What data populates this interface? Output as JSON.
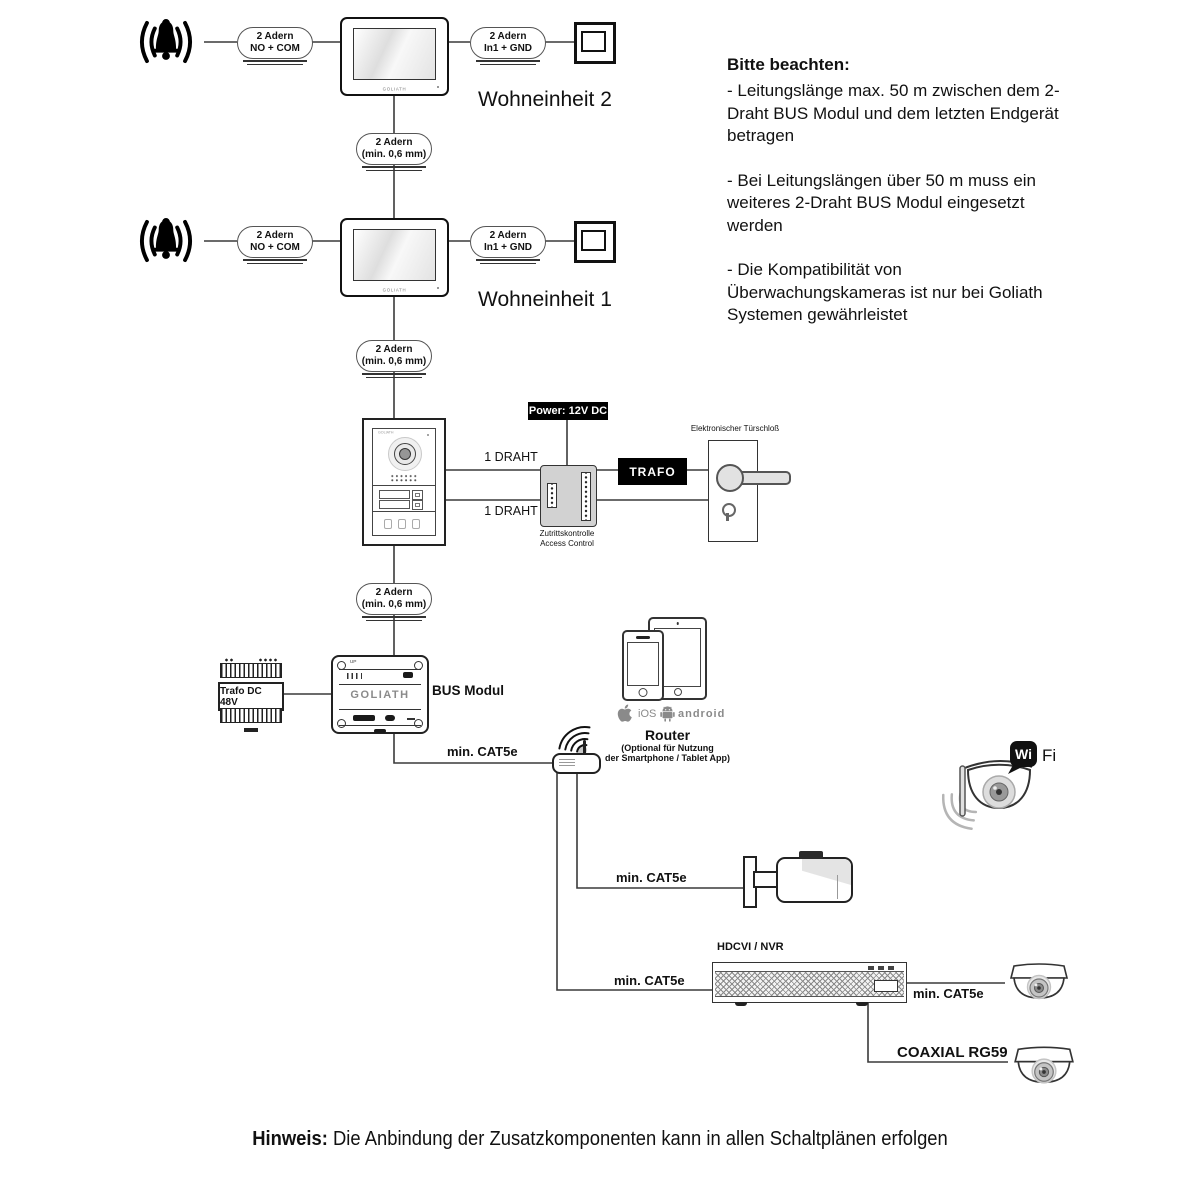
{
  "units": {
    "unit2": "Wohneinheit 2",
    "unit1": "Wohneinheit 1"
  },
  "pills": {
    "no_com": {
      "line1": "2 Adern",
      "line2": "NO + COM"
    },
    "in1_gnd": {
      "line1": "2 Adern",
      "line2": "In1 + GND"
    },
    "min06": {
      "line1": "2 Adern",
      "line2": "(min. 0,6 mm)"
    }
  },
  "notes": {
    "title": "Bitte beachten:",
    "items": [
      "- Leitungslänge max. 50 m zwischen dem 2-Draht BUS Modul und dem letzten Endgerät betragen",
      "- Bei Leitungslängen über 50 m muss ein weiteres 2-Draht BUS Modul eingesetzt werden",
      "- Die Kompatibilität von Überwachungskameras ist nur bei Goliath Systemen gewährleistet"
    ]
  },
  "monitor": {
    "brand": "GOLIATH"
  },
  "door_station": {
    "brand": "GOLIATH"
  },
  "power_label": "Power: 12V DC",
  "trafo_box": "TRAFO",
  "access_control": {
    "line1": "Zutrittskontrolle",
    "line2": "Access Control"
  },
  "door_lock_label": "Elektronischer Türschloß",
  "wire_labels": {
    "draht1": "1 DRAHT",
    "cat5e": "min. CAT5e",
    "coaxial": "COAXIAL RG59"
  },
  "trafo_din": "Trafo DC 48V",
  "bus_modul": {
    "label": "BUS Modul",
    "brand": "GOLIATH",
    "up": "UP"
  },
  "router": {
    "title": "Router",
    "subtitle1": "(Optional für Nutzung",
    "subtitle2": "der Smartphone / Tablet App)"
  },
  "platforms": {
    "ios": "iOS",
    "android": "android"
  },
  "wifi": {
    "wi": "Wi",
    "fi": "Fi"
  },
  "nvr_label": "HDCVI / NVR",
  "footer": {
    "bold": "Hinweis:",
    "text": " Die Anbindung der Zusatzkomponenten kann in allen Schaltplänen erfolgen"
  }
}
